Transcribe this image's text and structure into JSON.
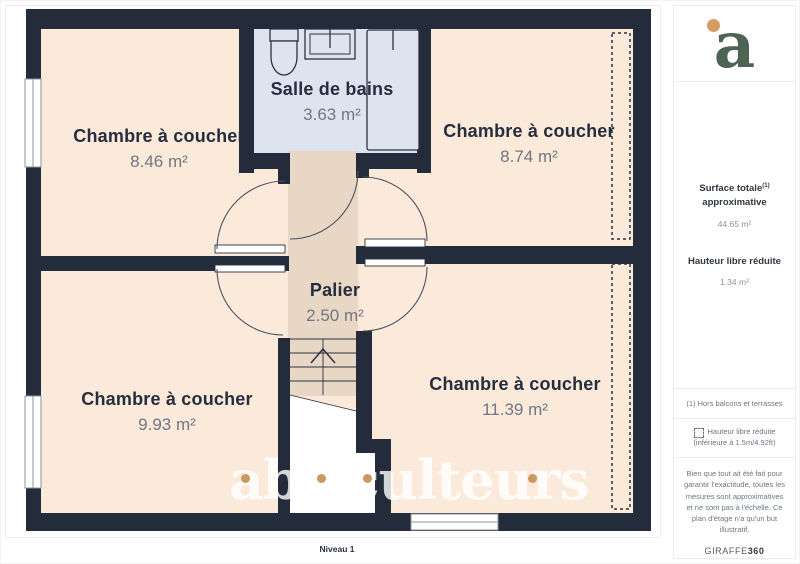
{
  "plan": {
    "rooms": [
      {
        "name": "Chambre à coucher",
        "area": "8.46 m²"
      },
      {
        "name": "Salle de bains",
        "area": "3.63 m²"
      },
      {
        "name": "Chambre à coucher",
        "area": "8.74 m²"
      },
      {
        "name": "Palier",
        "area": "2.50 m²"
      },
      {
        "name": "Chambre à coucher",
        "area": "9.93 m²"
      },
      {
        "name": "Chambre à coucher",
        "area": "11.39 m²"
      }
    ],
    "level_label": "Niveau 1",
    "watermark": "abriculteurs"
  },
  "sidebar": {
    "logo_letter": "a",
    "surface_title_line1": "Surface totale",
    "surface_sup": "(1)",
    "surface_title_line2": "approximative",
    "surface_value": "44.65 m²",
    "height_title": "Hauteur libre réduite",
    "height_value": "1.34 m²",
    "footnote": "(1) Hors balcons et terrasses",
    "legend_line1": "Hauteur libre réduite",
    "legend_line2": "(inférieure à 1.5m/4.92ft)",
    "disclaimer": "Bien que tout ait été fait pour garantir l'exactitude, toutes les mesures sont approximatives et ne sont pas à l'échelle. Ce plan d'étage n'a qu'un but illustratif.",
    "brand": "GIRAFFE",
    "brand_suffix": "360"
  },
  "colors": {
    "wall": "#242b3b",
    "bedroom_floor": "#fbe9da",
    "bathroom_floor": "#dee4ef",
    "landing_floor": "#e9d7c6",
    "accent_orange": "#c9995f",
    "logo_green": "#4d6353"
  }
}
